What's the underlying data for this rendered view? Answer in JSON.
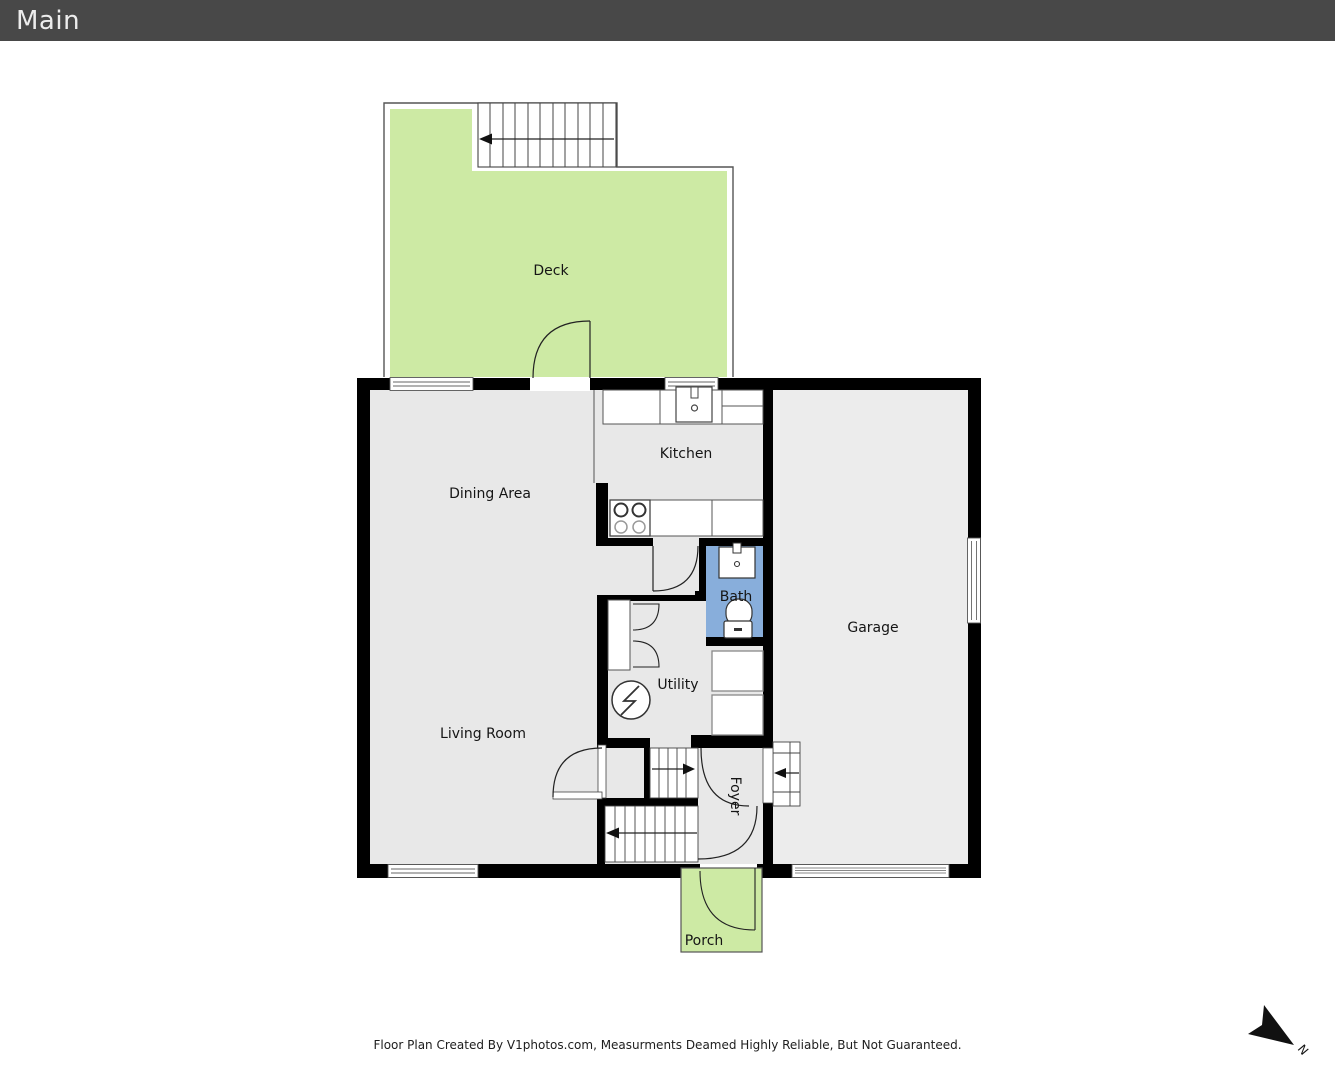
{
  "header": {
    "title": "Main"
  },
  "rooms": {
    "deck": {
      "label": "Deck"
    },
    "kitchen": {
      "label": "Kitchen"
    },
    "dining": {
      "label": "Dining Area"
    },
    "bath": {
      "label": "Bath"
    },
    "garage": {
      "label": "Garage"
    },
    "utility": {
      "label": "Utility"
    },
    "living": {
      "label": "Living Room"
    },
    "foyer": {
      "label": "Foyer"
    },
    "porch": {
      "label": "Porch"
    }
  },
  "compass": {
    "label": "N"
  },
  "footer": {
    "disclaimer": "Floor Plan Created By V1photos.com, Measurments Deamed Highly Reliable, But Not Guaranteed."
  },
  "colors": {
    "header_bg": "#484848",
    "wall": "#000000",
    "interior": "#e8e8e8",
    "garage_interior": "#ececec",
    "outdoor_green": "#cdeaa4",
    "bath_blue": "#88aedb"
  }
}
